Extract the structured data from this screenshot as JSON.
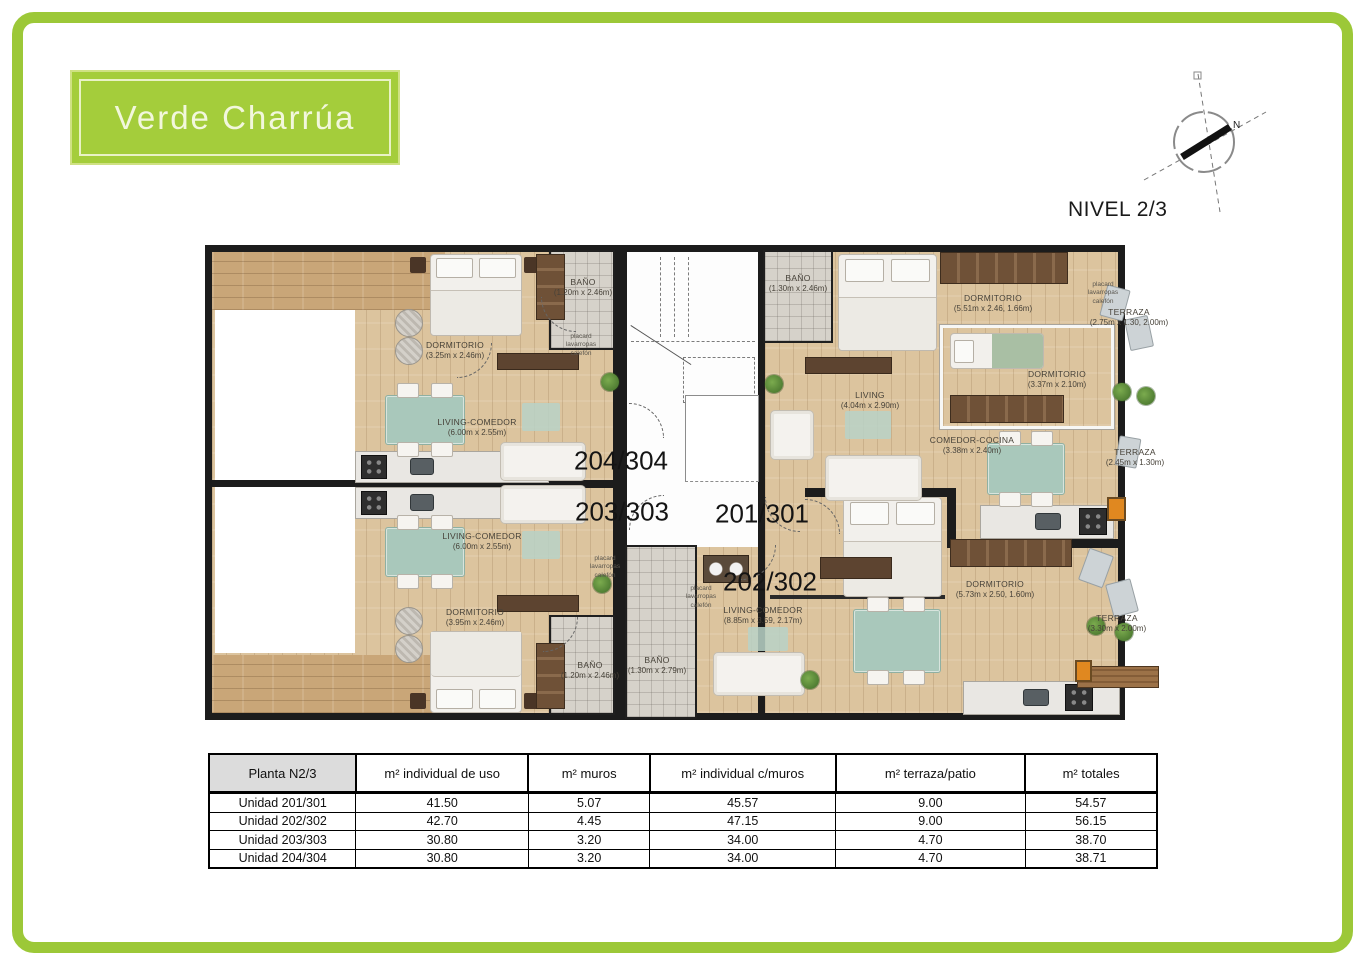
{
  "logo": {
    "text": "Verde Charrúa"
  },
  "header": {
    "level_label": "NIVEL 2/3"
  },
  "compass": {
    "north_label": "N"
  },
  "colors": {
    "frame_green": "#9cc838",
    "logo_green": "#a4cd3b",
    "wall": "#1c1c1c",
    "wood_floor": "#dcc49e",
    "deck_wood": "#c9a678",
    "bath_tile": "#d6d2ca",
    "terrace_tile": "#dbd6cb",
    "furniture_teal": "#a9c8bb"
  },
  "plan": {
    "unit_labels": [
      "204/304",
      "203/303",
      "201/301",
      "202/302"
    ],
    "closet_note": "placard lavarropas calefón",
    "rooms": [
      {
        "name": "DORMITORIO",
        "dims": "(3.25m x 2.46m)"
      },
      {
        "name": "LIVING-COMEDOR",
        "dims": "(6.00m x 2.55m)"
      },
      {
        "name": "BAÑO",
        "dims": "(1.20m x 2.46m)"
      },
      {
        "name": "LIVING-COMEDOR",
        "dims": "(6.00m x 2.55m)"
      },
      {
        "name": "DORMITORIO",
        "dims": "(3.95m x 2.46m)"
      },
      {
        "name": "BAÑO",
        "dims": "(1.20m x 2.46m)"
      },
      {
        "name": "BAÑO",
        "dims": "(1.30m x 2.46m)"
      },
      {
        "name": "DORMITORIO",
        "dims": "(5.51m x 2.46, 1.66m)"
      },
      {
        "name": "DORMITORIO",
        "dims": "(3.37m x 2.10m)"
      },
      {
        "name": "LIVING",
        "dims": "(4.04m x 2.90m)"
      },
      {
        "name": "COMEDOR-COCINA",
        "dims": "(3.38m x 2.40m)"
      },
      {
        "name": "TERRAZA",
        "dims": "(2.75m x 1.30, 2.00m)"
      },
      {
        "name": "TERRAZA",
        "dims": "(2.45m x 1.30m)"
      },
      {
        "name": "LIVING-COMEDOR",
        "dims": "(8.85m x 3.59, 2.17m)"
      },
      {
        "name": "DORMITORIO",
        "dims": "(5.73m x 2.50, 1.60m)"
      },
      {
        "name": "BAÑO",
        "dims": "(1.30m x 2.79m)"
      },
      {
        "name": "TERRAZA",
        "dims": "(3.30m x 2.00m)"
      }
    ]
  },
  "table": {
    "headers": [
      "Planta N2/3",
      "m² individual de uso",
      "m² muros",
      "m² individual c/muros",
      "m² terraza/patio",
      "m² totales"
    ],
    "rows": [
      {
        "unit": "Unidad 201/301",
        "values": [
          "41.50",
          "5.07",
          "45.57",
          "9.00",
          "54.57"
        ]
      },
      {
        "unit": "Unidad 202/302",
        "values": [
          "42.70",
          "4.45",
          "47.15",
          "9.00",
          "56.15"
        ]
      },
      {
        "unit": "Unidad 203/303",
        "values": [
          "30.80",
          "3.20",
          "34.00",
          "4.70",
          "38.70"
        ]
      },
      {
        "unit": "Unidad 204/304",
        "values": [
          "30.80",
          "3.20",
          "34.00",
          "4.70",
          "38.71"
        ]
      }
    ]
  }
}
